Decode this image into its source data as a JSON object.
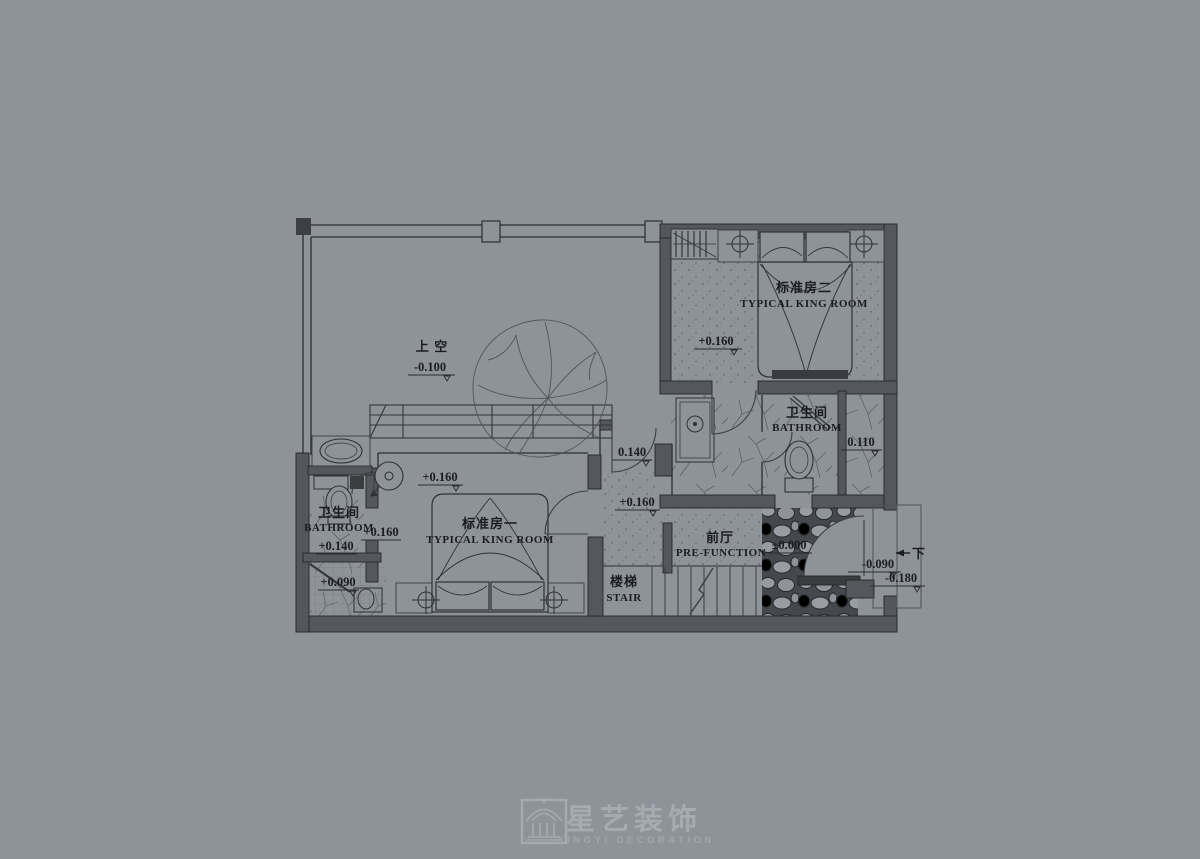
{
  "canvas": {
    "background": "#8e939a",
    "ink": "#26282a"
  },
  "rooms": {
    "void": {
      "name_cn": "上 空",
      "level": "-0.100"
    },
    "king2": {
      "name_cn": "标准房二",
      "name_en": "TYPICAL KING ROOM",
      "level": "+0.160"
    },
    "bath2": {
      "name_cn": "卫生间",
      "name_en": "BATHROOM",
      "shower_level": "0.110"
    },
    "king1": {
      "name_cn": "标准房一",
      "name_en": "TYPICAL KING ROOM",
      "level": "+0.160"
    },
    "bath1": {
      "name_cn": "卫生间",
      "name_en": "BATHROOM",
      "level": "+0.140",
      "entry_level": "+0.160",
      "shower_level": "+0.090"
    },
    "stair": {
      "name_cn": "楼梯",
      "name_en": "STAIR"
    },
    "prefunction": {
      "name_cn": "前厅",
      "name_en": "PRE-FUNCTION",
      "level": "±0.000"
    }
  },
  "corridor": {
    "level_a": "0.140",
    "level_b": "+0.160"
  },
  "exit": {
    "level_a": "-0.090",
    "level_b": "-0.180",
    "direction": "下"
  },
  "watermark": {
    "name_cn": "星艺装饰",
    "name_en": "XINGYI DECORATION"
  }
}
